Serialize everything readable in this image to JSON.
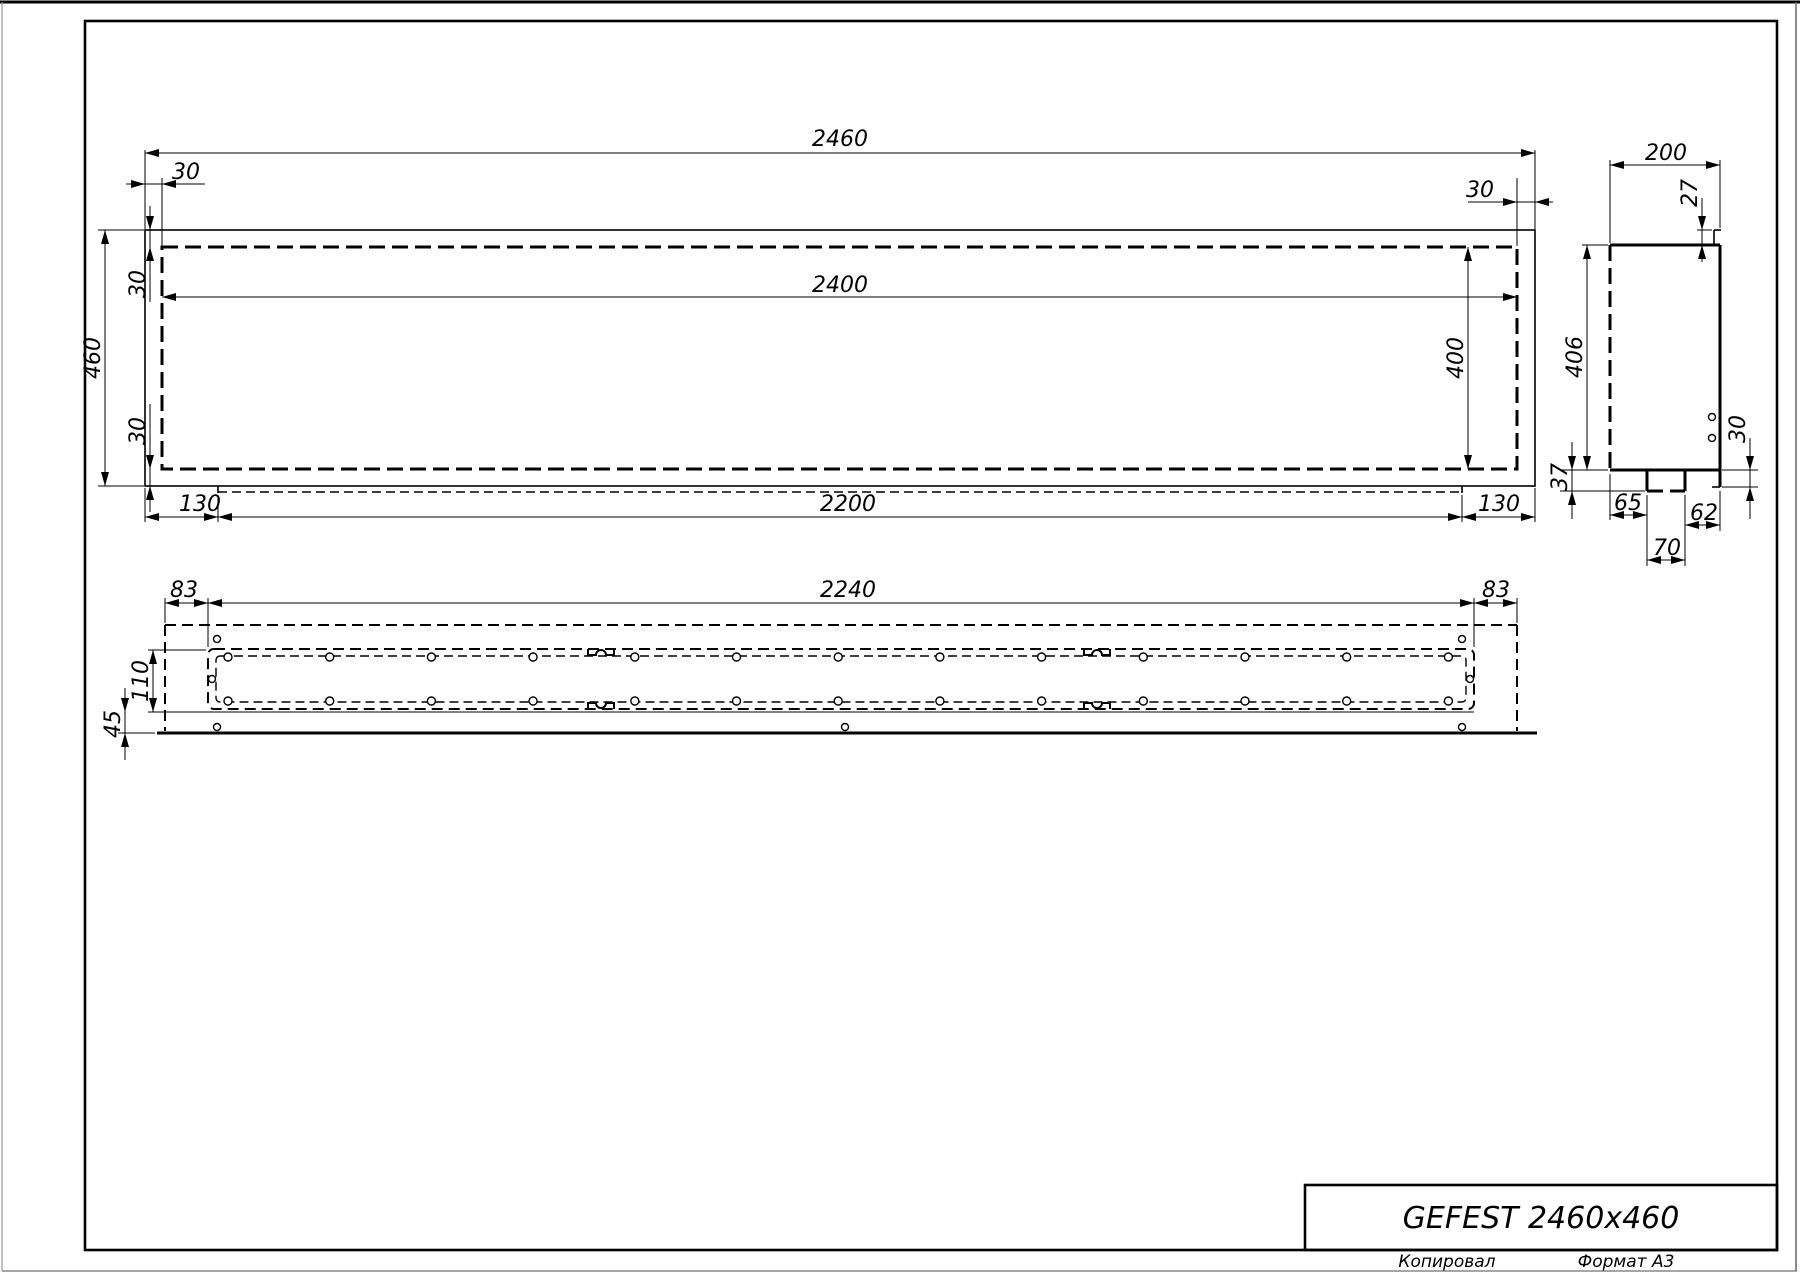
{
  "sheet": {
    "title_block": {
      "title": "GEFEST 2460x460",
      "copied_label": "Копировал",
      "format_label": "Формат А3"
    }
  },
  "front_view": {
    "dims": {
      "total_width": "2460",
      "inner_width": "2400",
      "total_height": "460",
      "inner_height": "400",
      "top_inset_left": "30",
      "top_inset_right": "30",
      "left_inset_top": "30",
      "left_inset_bottom": "30",
      "tray_margin_left": "130",
      "tray_length": "2200",
      "tray_margin_right": "130"
    }
  },
  "side_view": {
    "dims": {
      "depth": "200",
      "top_flange": "27",
      "height": "406",
      "notch_drop": "37",
      "hole_offset": "30",
      "foot_left": "65",
      "foot_right": "62",
      "notch_width": "70"
    }
  },
  "bottom_view": {
    "dims": {
      "slot_margin_left": "83",
      "slot_length": "2240",
      "slot_margin_right": "83",
      "slot_width": "110",
      "front_offset": "45"
    }
  }
}
